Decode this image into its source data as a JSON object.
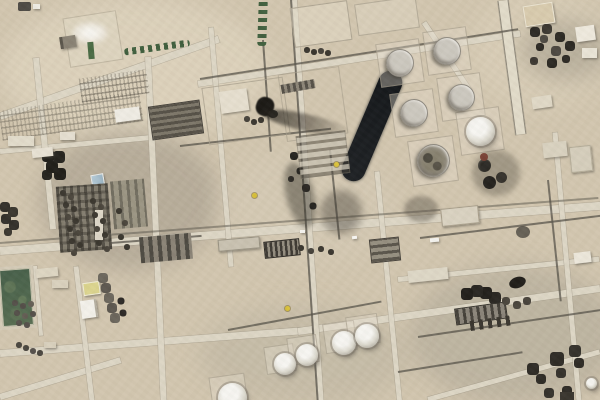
{
  "image": {
    "kind": "satellite photograph",
    "subject": "Overhead satellite view of a desert oil-processing facility: circular storage tank farm, white spheroid tanks, dense processing units, pipe racks and tilted road grid, a long dark lagoon, black burn marks with a gray smoke-shadow streak, a green field, tree rows and parking yards on tan desert ground",
    "aria_label": "Satellite image of an oil processing facility in desert terrain",
    "width_px": 600,
    "height_px": 400
  },
  "colors": {
    "ground": "#d2c6af",
    "ground-light": "#e2d9c4",
    "ground-gray": "#b9b2a2",
    "road": "#ddd6c5",
    "road-edge": "#a59d8a",
    "rack": "#57534a",
    "pond": "#17191c",
    "tank-shell": "#c5c0b6",
    "tank-rim": "#8f8a80",
    "dome-white": "#f2f1ed",
    "smoke": "#37332c",
    "burn-black": "#1d1b17",
    "burn-red": "#7a4336",
    "field-green": "#4e644c",
    "field-green-dark": "#40553f",
    "tree-green": "#41603f",
    "blue-roof": "#a9c2d1",
    "yellow-roof": "#dbd48e",
    "marker-yellow": "#d9c13a",
    "white-building": "#efece4",
    "dark-unit": "#4a453d"
  },
  "features": [
    {
      "name": "storage-tank-farm",
      "desc": "five large gray circular storage tanks on square pads plus one bright white dome tank",
      "area": "top right"
    },
    {
      "name": "dark-lagoon",
      "desc": "long near-black rectangular pit with rounded ends, tilted",
      "area": "upper center-right"
    },
    {
      "name": "burn-and-smoke-stains",
      "desc": "black burn blobs with gray smoke shadow streak trailing southeast and mottled dark stains",
      "area": "center"
    },
    {
      "name": "damaged-small-tanks",
      "desc": "three small blackened tanks with a reddish scorch spot",
      "area": "right of tank farm"
    },
    {
      "name": "processing-plant-west",
      "desc": "dense unit rows, exchanger dot rows, blue-roof building, cluster of five black tanks, white buildings",
      "area": "center left"
    },
    {
      "name": "processing-trains-southeast",
      "desc": "four dark circular vessels over striped unit rows plus dark spidery well clusters",
      "area": "bottom right"
    },
    {
      "name": "spheroid-tank-row",
      "desc": "five white dome tanks in a diagonal row on light pads",
      "area": "bottom center"
    },
    {
      "name": "green-field",
      "desc": "dark mottled green rectangular field with light border",
      "area": "bottom left corner"
    },
    {
      "name": "parking-yards",
      "desc": "two striped bands of parked vehicles and laydown equipment",
      "area": "upper left"
    },
    {
      "name": "tree-rows",
      "desc": "horizontal tree row near compound and vertical tree row at top center",
      "area": "upper left / top center"
    },
    {
      "name": "walled-compound",
      "desc": "square compound with white steam plume and small green strip",
      "area": "top left"
    },
    {
      "name": "road-network",
      "desc": "tilted grid of light desert roads with parallel dark pipe racks",
      "area": "throughout"
    }
  ]
}
